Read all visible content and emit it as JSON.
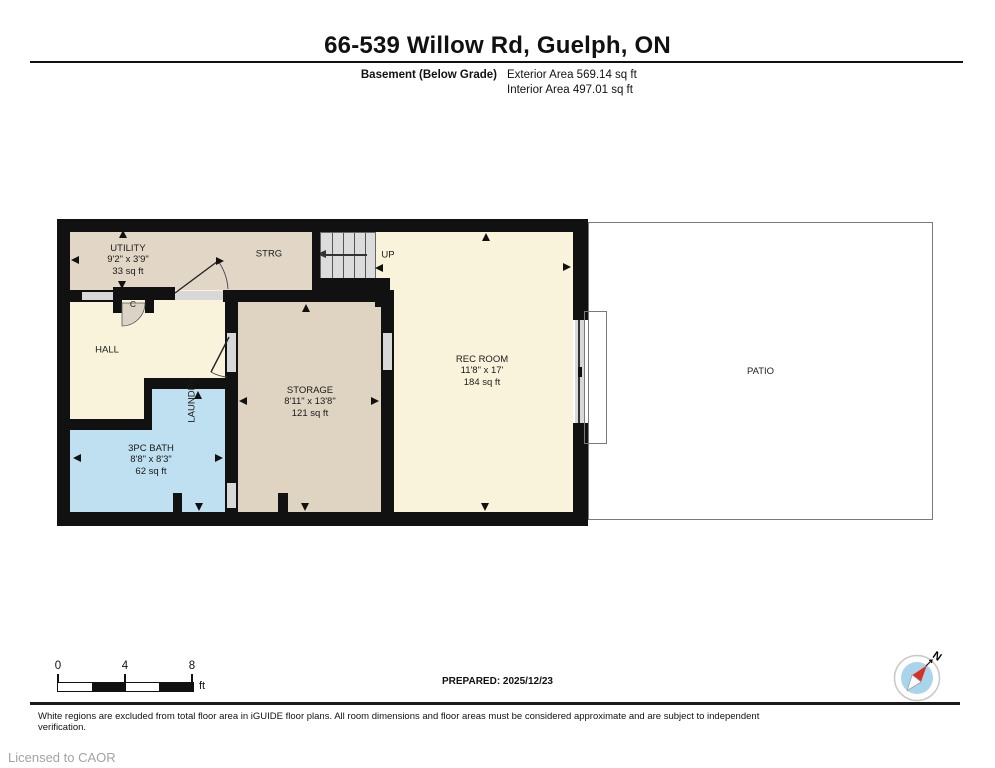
{
  "header": {
    "title": "66-539 Willow Rd, Guelph, ON",
    "floor_label": "Basement (Below Grade)",
    "exterior_area": "Exterior Area 569.14 sq ft",
    "interior_area": "Interior Area 497.01 sq ft"
  },
  "rooms": {
    "utility": {
      "name": "UTILITY",
      "dims": "9'2\" x 3'9\"",
      "area": "33 sq ft"
    },
    "strg": {
      "name": "STRG"
    },
    "stairs": {
      "direction_label": "UP"
    },
    "closet": {
      "name": "C"
    },
    "hall": {
      "name": "HALL"
    },
    "laundry": {
      "name": "LAUNDRY"
    },
    "storage": {
      "name": "STORAGE",
      "dims": "8'11\" x 13'8\"",
      "area": "121 sq ft"
    },
    "rec_room": {
      "name": "REC ROOM",
      "dims": "11'8\" x 17'",
      "area": "184 sq ft"
    },
    "bath": {
      "name": "3PC BATH",
      "dims": "8'8\" x 8'3\"",
      "area": "62 sq ft"
    },
    "patio": {
      "name": "PATIO"
    }
  },
  "scale_bar": {
    "ticks": [
      "0",
      "4",
      "8"
    ],
    "unit": "ft"
  },
  "compass": {
    "north_label": "N"
  },
  "footer": {
    "prepared": "PREPARED: 2025/12/23",
    "disclaimer": "White regions are excluded from total floor area in iGUIDE floor plans. All room dimensions and floor areas must be considered approximate and are subject to independent verification.",
    "license": "Licensed to CAOR"
  },
  "colors": {
    "wall": "#111111",
    "interior_cream": "#FAF3DC",
    "utility_tan": "#E2D7C6",
    "storage_tan": "#DFD4C2",
    "wet_room_blue": "#BEE0F1",
    "opening_gray": "#D8D8D8",
    "stairs_gray": "#DCDCDC",
    "compass_blue": "#A9D5EC",
    "compass_needle_red": "#D93025"
  }
}
